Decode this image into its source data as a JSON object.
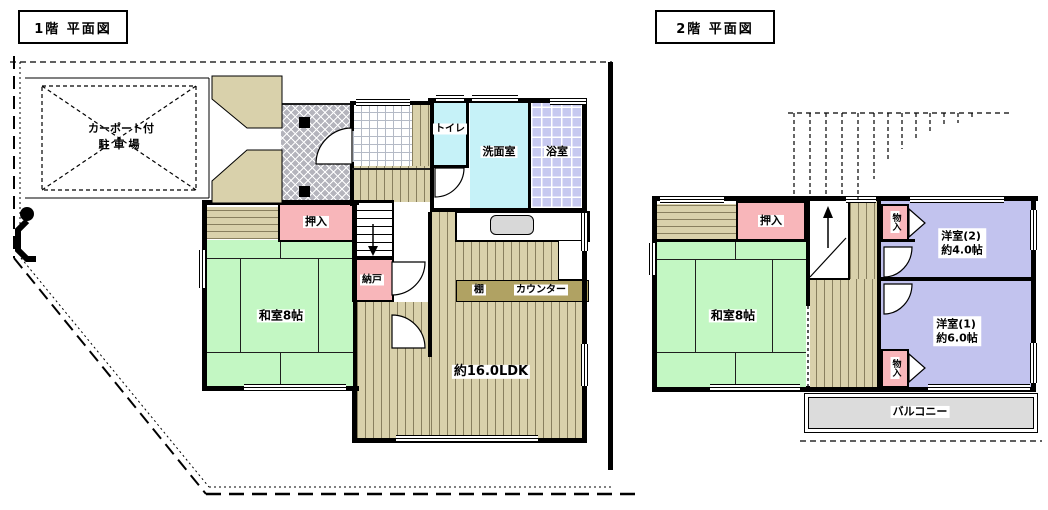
{
  "floor1": {
    "title": "1階 平面図",
    "carport": {
      "line1": "カーポート付",
      "line2": "駐車場"
    },
    "rooms": {
      "toilet": "トイレ",
      "washroom": "洗面室",
      "bath": "浴室",
      "oshiire": "押入",
      "nando": "納戸",
      "washitsu": "和室8帖",
      "ldk": "約16.0LDK",
      "shelf": "棚",
      "counter": "カウンター"
    }
  },
  "floor2": {
    "title": "2階 平面図",
    "rooms": {
      "oshiire": "押入",
      "washitsu": "和室8帖",
      "monoire_upper": "物入",
      "monoire_lower": "物入",
      "yoshitsu2": {
        "line1": "洋室(2)",
        "line2": "約4.0帖"
      },
      "yoshitsu1": {
        "line1": "洋室(1)",
        "line2": "約6.0帖"
      },
      "balcony": "バルコニー"
    }
  },
  "colors": {
    "tatami_green": "#c3f7c3",
    "closet_pink": "#f8b6ba",
    "water_cyan": "#c6f2f8",
    "bath_lavender": "#c7c9f0",
    "western_lavender": "#c2c3ee",
    "wood_floor": "#d9d1ab",
    "balcony_gray": "#dcdcdc",
    "counter_olive": "#b0a263",
    "porch_gray": "#b4b4bc"
  }
}
